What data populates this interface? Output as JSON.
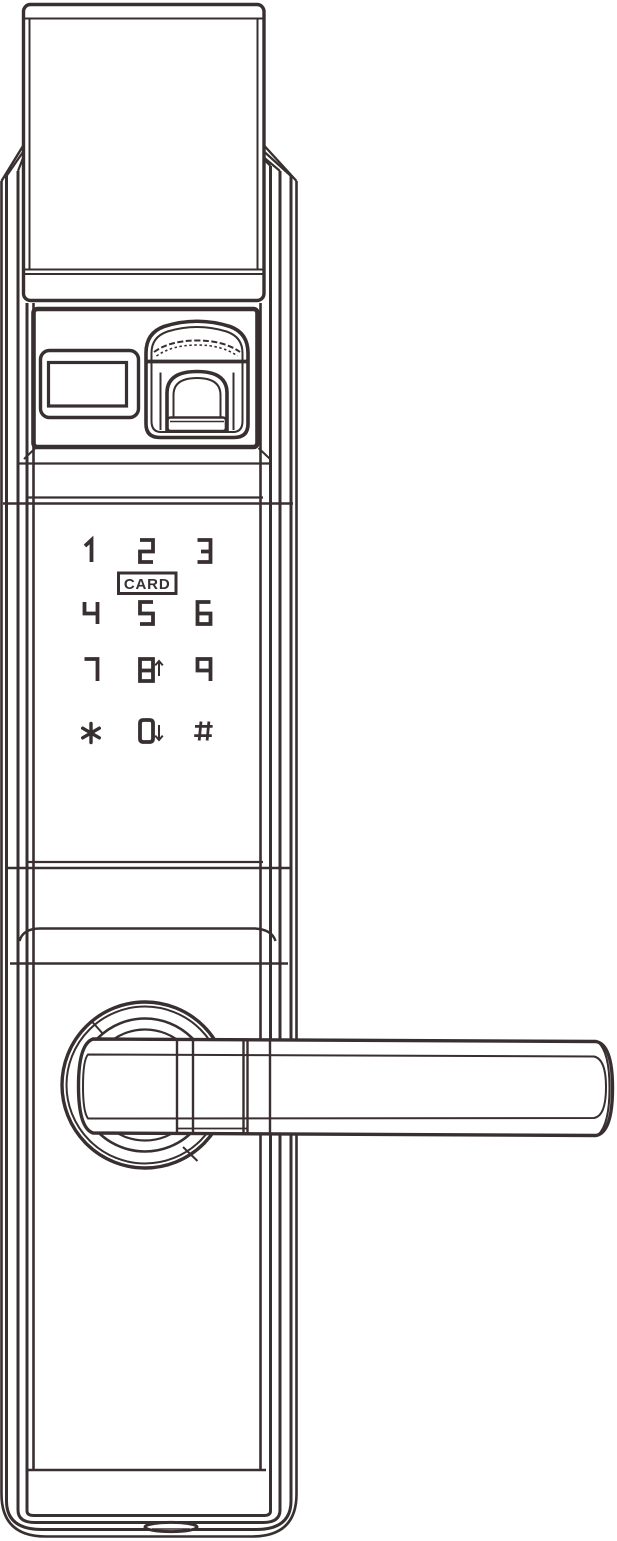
{
  "title": "Electronic smart door lock — front view line drawing",
  "colors": {
    "line": "#382f30",
    "background": "#ffffff"
  },
  "keypad": {
    "rows": [
      [
        "1",
        "2",
        "3"
      ],
      [
        "4",
        "5",
        "6"
      ],
      [
        "7",
        "8",
        "9"
      ],
      [
        "*",
        "0",
        "#"
      ]
    ],
    "card_label": "CARD",
    "arrows": [
      {
        "key": "8",
        "direction": "up"
      },
      {
        "key": "0",
        "direction": "down"
      }
    ]
  },
  "components": {
    "top_cover": "top-cover",
    "display_window": "display-window",
    "fingerprint_reader": "fingerprint-reader",
    "card_zone": "card-tap-zone",
    "handle": "door-handle-lever",
    "rosette": "handle-rosette",
    "bottom_port": "bottom-port"
  }
}
